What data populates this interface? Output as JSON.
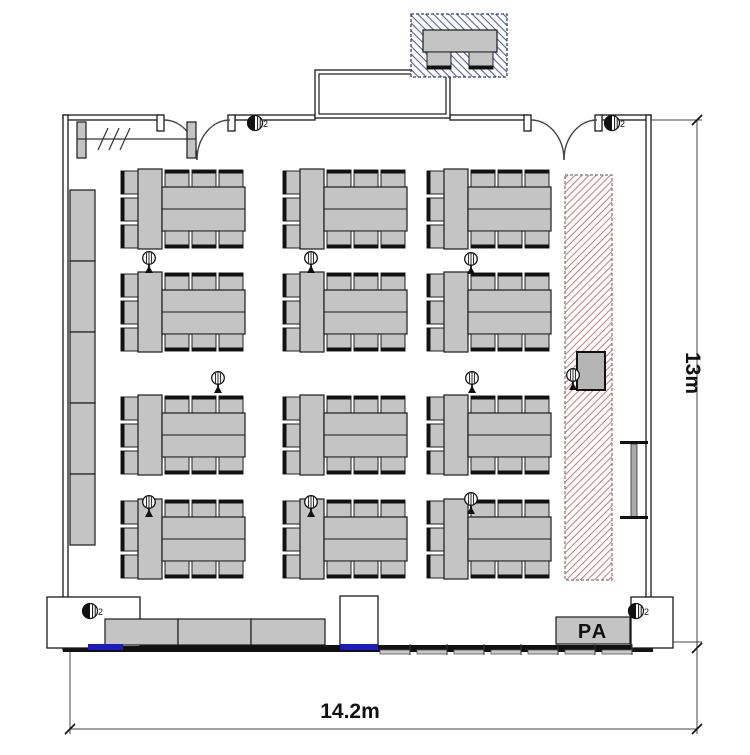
{
  "labels": {
    "pa": "PA",
    "width_dim": "14.2m",
    "height_dim": "13m",
    "speaker_badge": "2"
  },
  "colors": {
    "furniture_fill": "#c4c4c4",
    "wall": "#1a1a1a",
    "stage_hatch": "#c46a6a",
    "reception_hatch": "#5560a8",
    "floor_marker_blue": "#1b1bbe"
  },
  "plan": {
    "table_groups": [
      {
        "x": 121,
        "y": 169
      },
      {
        "x": 283,
        "y": 169
      },
      {
        "x": 427,
        "y": 169
      },
      {
        "x": 121,
        "y": 272
      },
      {
        "x": 283,
        "y": 272
      },
      {
        "x": 427,
        "y": 272
      },
      {
        "x": 121,
        "y": 395
      },
      {
        "x": 283,
        "y": 395
      },
      {
        "x": 427,
        "y": 395
      },
      {
        "x": 121,
        "y": 499
      },
      {
        "x": 283,
        "y": 499
      },
      {
        "x": 427,
        "y": 499
      }
    ],
    "mics": [
      {
        "x": 142,
        "y": 251
      },
      {
        "x": 304,
        "y": 251
      },
      {
        "x": 464,
        "y": 252
      },
      {
        "x": 211,
        "y": 371
      },
      {
        "x": 465,
        "y": 371
      },
      {
        "x": 566,
        "y": 368
      },
      {
        "x": 142,
        "y": 495
      },
      {
        "x": 304,
        "y": 495
      },
      {
        "x": 464,
        "y": 492
      }
    ],
    "speakers": [
      {
        "x": 255,
        "y": 123
      },
      {
        "x": 612,
        "y": 123
      },
      {
        "x": 90,
        "y": 611
      },
      {
        "x": 636,
        "y": 611
      }
    ],
    "counter_segments": [
      {
        "x": 70,
        "y": 190,
        "w": 25,
        "h": 71
      },
      {
        "x": 70,
        "y": 261,
        "w": 25,
        "h": 71
      },
      {
        "x": 70,
        "y": 332,
        "w": 25,
        "h": 71
      },
      {
        "x": 70,
        "y": 403,
        "w": 25,
        "h": 71
      },
      {
        "x": 70,
        "y": 474,
        "w": 25,
        "h": 71
      }
    ],
    "bottom_tables": [
      {
        "x": 105,
        "y": 619,
        "w": 73,
        "h": 26
      },
      {
        "x": 178,
        "y": 619,
        "w": 73,
        "h": 26
      },
      {
        "x": 251,
        "y": 619,
        "w": 74,
        "h": 26
      }
    ],
    "table_dashes": [
      {
        "x": 112,
        "y": 646,
        "w": 30,
        "h": 3.5
      },
      {
        "x": 157,
        "y": 646,
        "w": 30,
        "h": 3.5
      },
      {
        "x": 202,
        "y": 646,
        "w": 30,
        "h": 3.5
      },
      {
        "x": 247,
        "y": 646,
        "w": 30,
        "h": 3.5
      },
      {
        "x": 292,
        "y": 646,
        "w": 30,
        "h": 3.5
      }
    ],
    "outlets": [
      {
        "x": 380
      },
      {
        "x": 417
      },
      {
        "x": 454
      },
      {
        "x": 491
      },
      {
        "x": 528
      },
      {
        "x": 565
      },
      {
        "x": 602
      }
    ],
    "blue_markers": [
      {
        "x": 88,
        "y": 644,
        "w": 35,
        "h": 6
      },
      {
        "x": 340,
        "y": 644,
        "w": 38,
        "h": 6
      }
    ]
  }
}
